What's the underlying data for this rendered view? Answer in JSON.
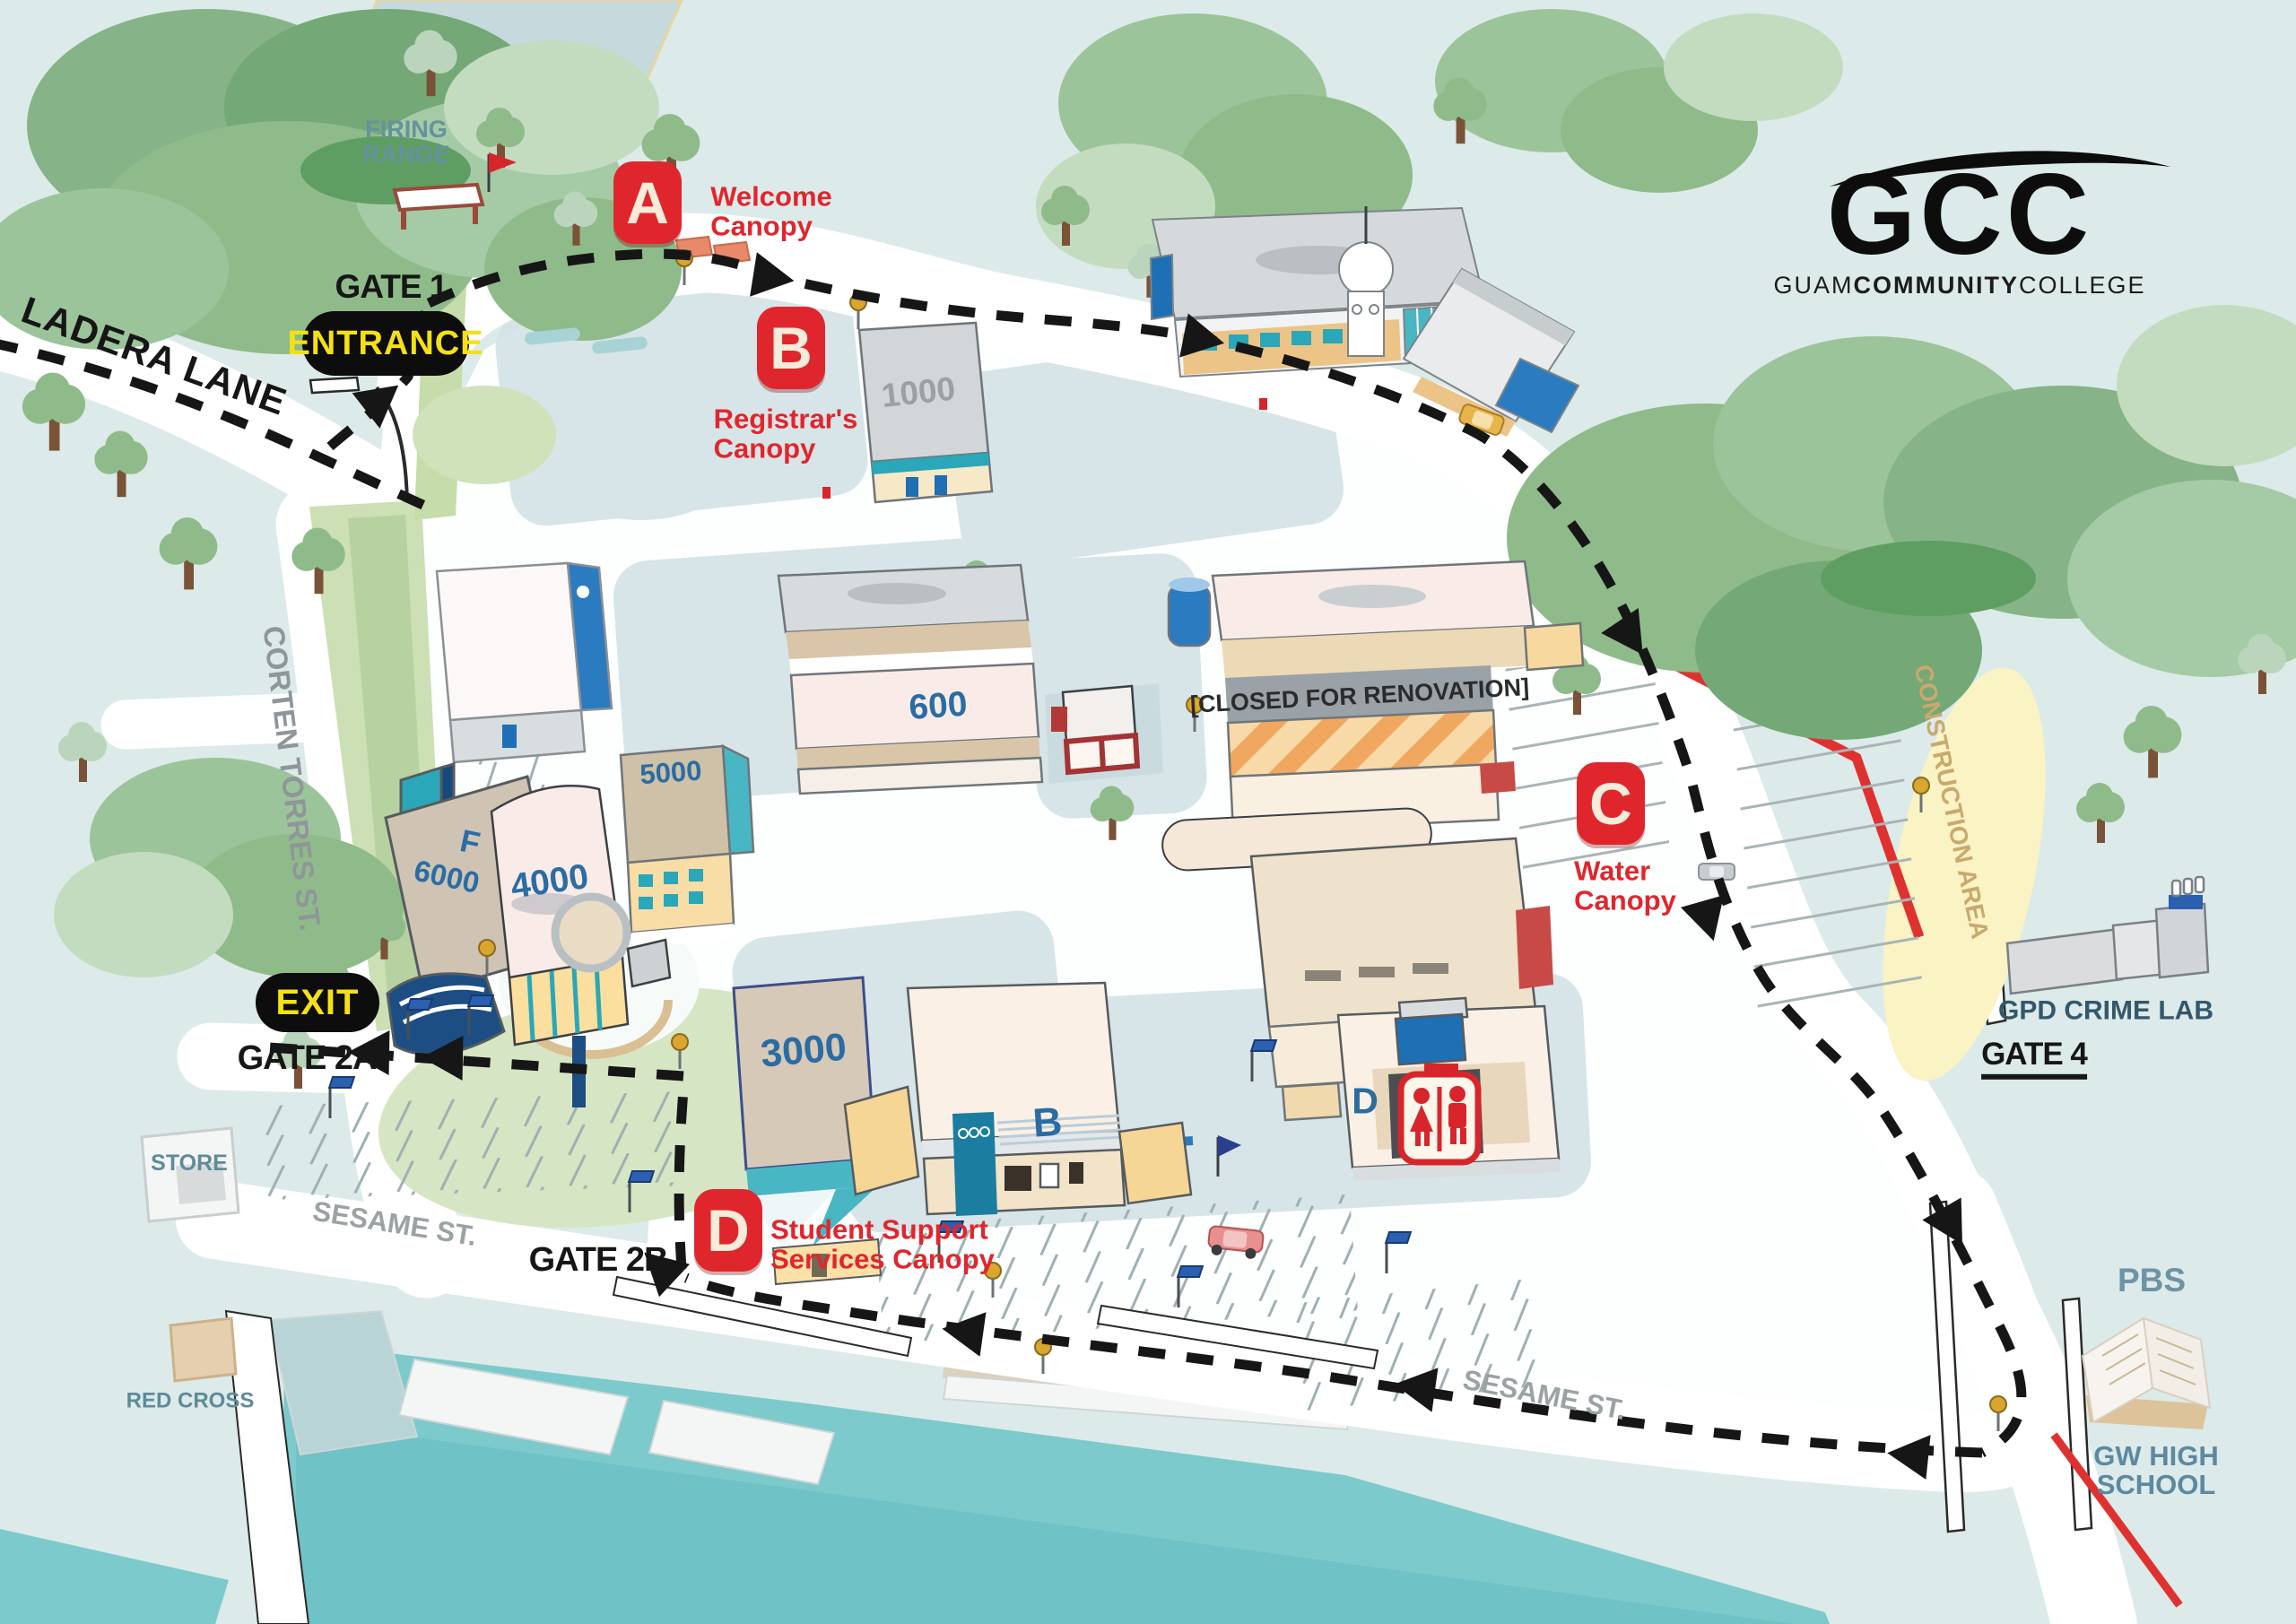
{
  "logo": {
    "acronym": "GCC",
    "name_part1": "GUAM",
    "name_part2": "COMMUNITY",
    "name_part3": "COLLEGE"
  },
  "canopies": [
    {
      "letter": "A",
      "line1": "Welcome",
      "line2": "Canopy"
    },
    {
      "letter": "B",
      "line1": "Registrar's",
      "line2": "Canopy"
    },
    {
      "letter": "C",
      "line1": "Water",
      "line2": "Canopy"
    },
    {
      "letter": "D",
      "line1": "Student Support",
      "line2": "Services Canopy"
    }
  ],
  "gates": {
    "gate1": "GATE 1",
    "gate2a": "GATE 2A",
    "gate2b": "GATE 2B",
    "gate4": "GATE 4"
  },
  "signs": {
    "entrance": "ENTRANCE",
    "exit": "EXIT"
  },
  "streets": {
    "ladera": "LADERA LANE",
    "corten": "CORTEN TORRES ST.",
    "sesame_west": "SESAME ST.",
    "sesame_east": "SESAME ST."
  },
  "buildings": {
    "b1000": "1000",
    "b600": "600",
    "b5000": "5000",
    "f": "F",
    "b6000": "6000",
    "b4000": "4000",
    "b3000": "3000",
    "bB": "B",
    "bD": "D"
  },
  "areas": {
    "firing_line1": "FIRING",
    "firing_line2": "RANGE",
    "construction": "CONSTRUCTION AREA",
    "closed": "[CLOSED FOR RENOVATION]"
  },
  "landmarks": {
    "store": "STORE",
    "red_cross": "RED CROSS",
    "gpd": "GPD CRIME LAB",
    "pbs": "PBS",
    "gwhs_line1": "GW HIGH",
    "gwhs_line2": "SCHOOL"
  },
  "colors": {
    "badge_red": "#e0262d",
    "route_black": "#161616",
    "water_teal": "#7ccacc",
    "sign_yellow": "#f5e017"
  }
}
